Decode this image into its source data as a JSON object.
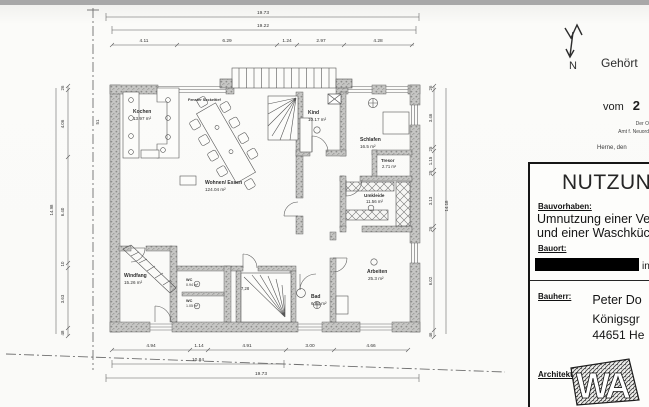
{
  "plan": {
    "dims_top": {
      "total_outer": "19.73",
      "total_inner": "19.22",
      "segments": [
        "4.11",
        "6.29",
        "1.24",
        "2.97",
        "4.28"
      ]
    },
    "dims_bottom": {
      "segments": [
        "4.94",
        "1.14",
        "4.91",
        "3.00",
        "4.66"
      ],
      "mid_total": "10.84",
      "total": "19.73"
    },
    "dims_left": {
      "total": "14.98",
      "segments": [
        "26",
        "4.06",
        "6.40",
        "10",
        "3.63",
        "48"
      ]
    },
    "dims_right": {
      "total": "14.18",
      "segments": [
        "26",
        "3.46",
        "25",
        "1.15",
        "25",
        "3.13",
        "26",
        "6.02",
        "46"
      ]
    },
    "edge_mark": "51",
    "rooms": [
      {
        "name": "Kochen",
        "area": "13.97 m²"
      },
      {
        "name": "Wohnen/ Essen",
        "area": "124.04 m²"
      },
      {
        "name": "Kind",
        "area": "10.17 m²"
      },
      {
        "name": "Schlafen",
        "area": "16.5 m²"
      },
      {
        "name": "Tresor",
        "area": "2.71 m²"
      },
      {
        "name": "Umkleide",
        "area": "11.56 m²"
      },
      {
        "name": "Arbeiten",
        "area": "25.3 m²"
      },
      {
        "name": "Windfang",
        "area": "15.26 m²"
      },
      {
        "name": "WC",
        "area": "0.94 m²"
      },
      {
        "name": "WC",
        "area": "1.05 m²"
      },
      {
        "name": "Bad",
        "area": "6.84 m²"
      }
    ],
    "notes": {
      "window": "Fenster Sockeltief",
      "stair_value": "7,28"
    }
  },
  "side": {
    "north_label": "N",
    "stamp_line1": "Gehört",
    "stamp_vom": "vom",
    "stamp_number": "2",
    "stamp_small1": "Der O",
    "stamp_small2": "Amt f. Neuord",
    "stamp_herne": "Herne, den",
    "titleblock": {
      "header": "NUTZUNG",
      "bauvorhaben_label": "Bauvorhaben:",
      "bauvorhaben_line1": "Umnutzung einer Versi",
      "bauvorhaben_line2": "und einer Waschküche",
      "bauort_label": "Bauort:",
      "bauort_suffix": "in",
      "bauherr_label": "Bauherr:",
      "bauherr_name": "Peter Do",
      "bauherr_street": "Königsgr",
      "bauherr_city": "44651 He",
      "architekt_label": "Architekt:"
    }
  },
  "colors": {
    "ink": "#3a3a3a",
    "wall_fill": "#c4c4c4",
    "paper": "#fafaf8"
  }
}
